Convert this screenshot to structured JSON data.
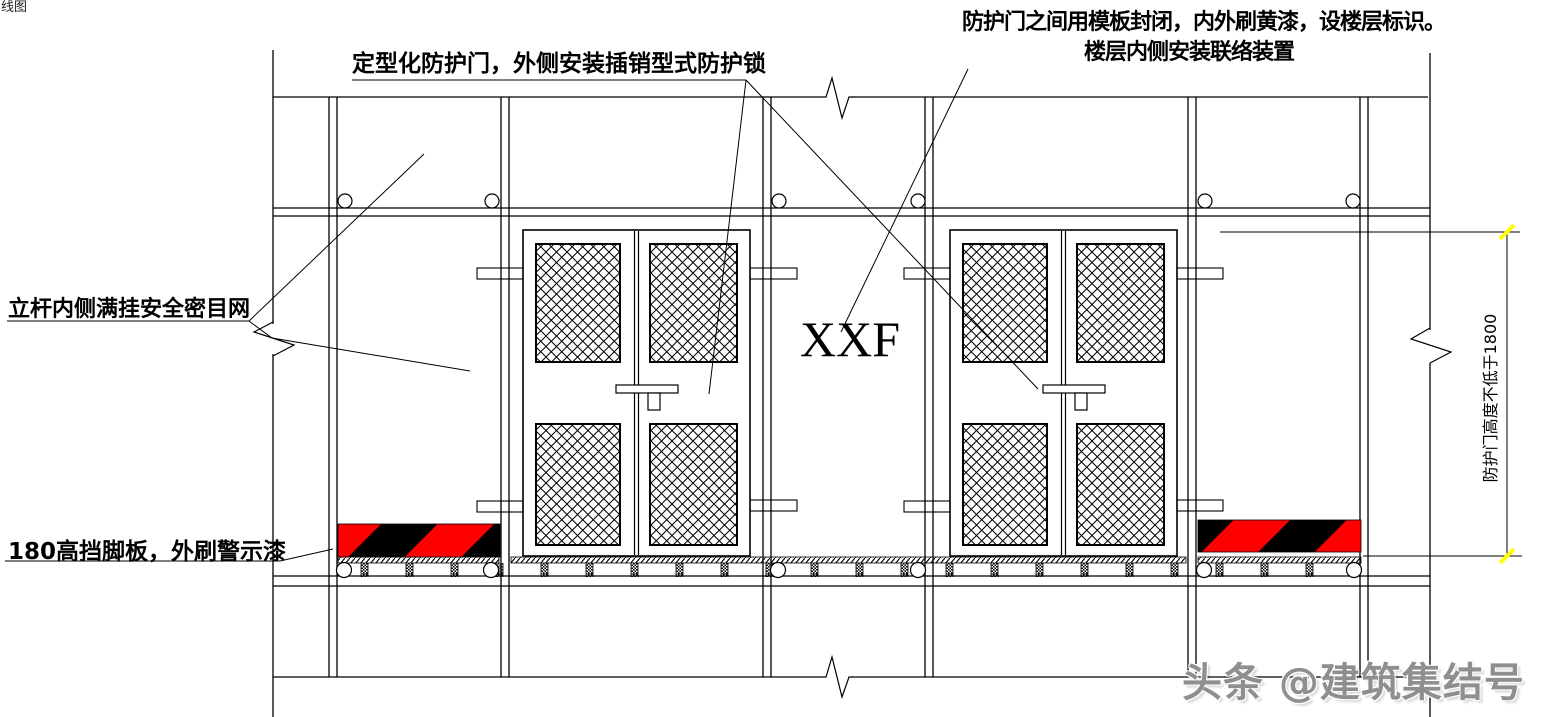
{
  "drawing": {
    "corner_fragment": "线图",
    "labels": {
      "top_center": "定型化防护门，外侧安装插销型式防护锁",
      "top_right_line1": "防护门之间用模板封闭，内外刷黄漆，设楼层标识。",
      "top_right_line2": "楼层内侧安装联络装置",
      "left_net": "立杆内侧满挂安全密目网",
      "toe_board": "180高挡脚板，外刷警示漆",
      "door_mark": "XXF",
      "height_dimension": "防护门高度不低于1800"
    },
    "dimension": {
      "value": "1800",
      "note": "防护门高度不低于1800"
    },
    "watermark": "头条 @建筑集结号",
    "colors": {
      "line": "#000000",
      "warning_red": "#ff0000",
      "warning_black": "#000000",
      "dimension_tick": "#ffff00",
      "watermark_gray": "#8f8f8f",
      "background": "#ffffff"
    }
  }
}
